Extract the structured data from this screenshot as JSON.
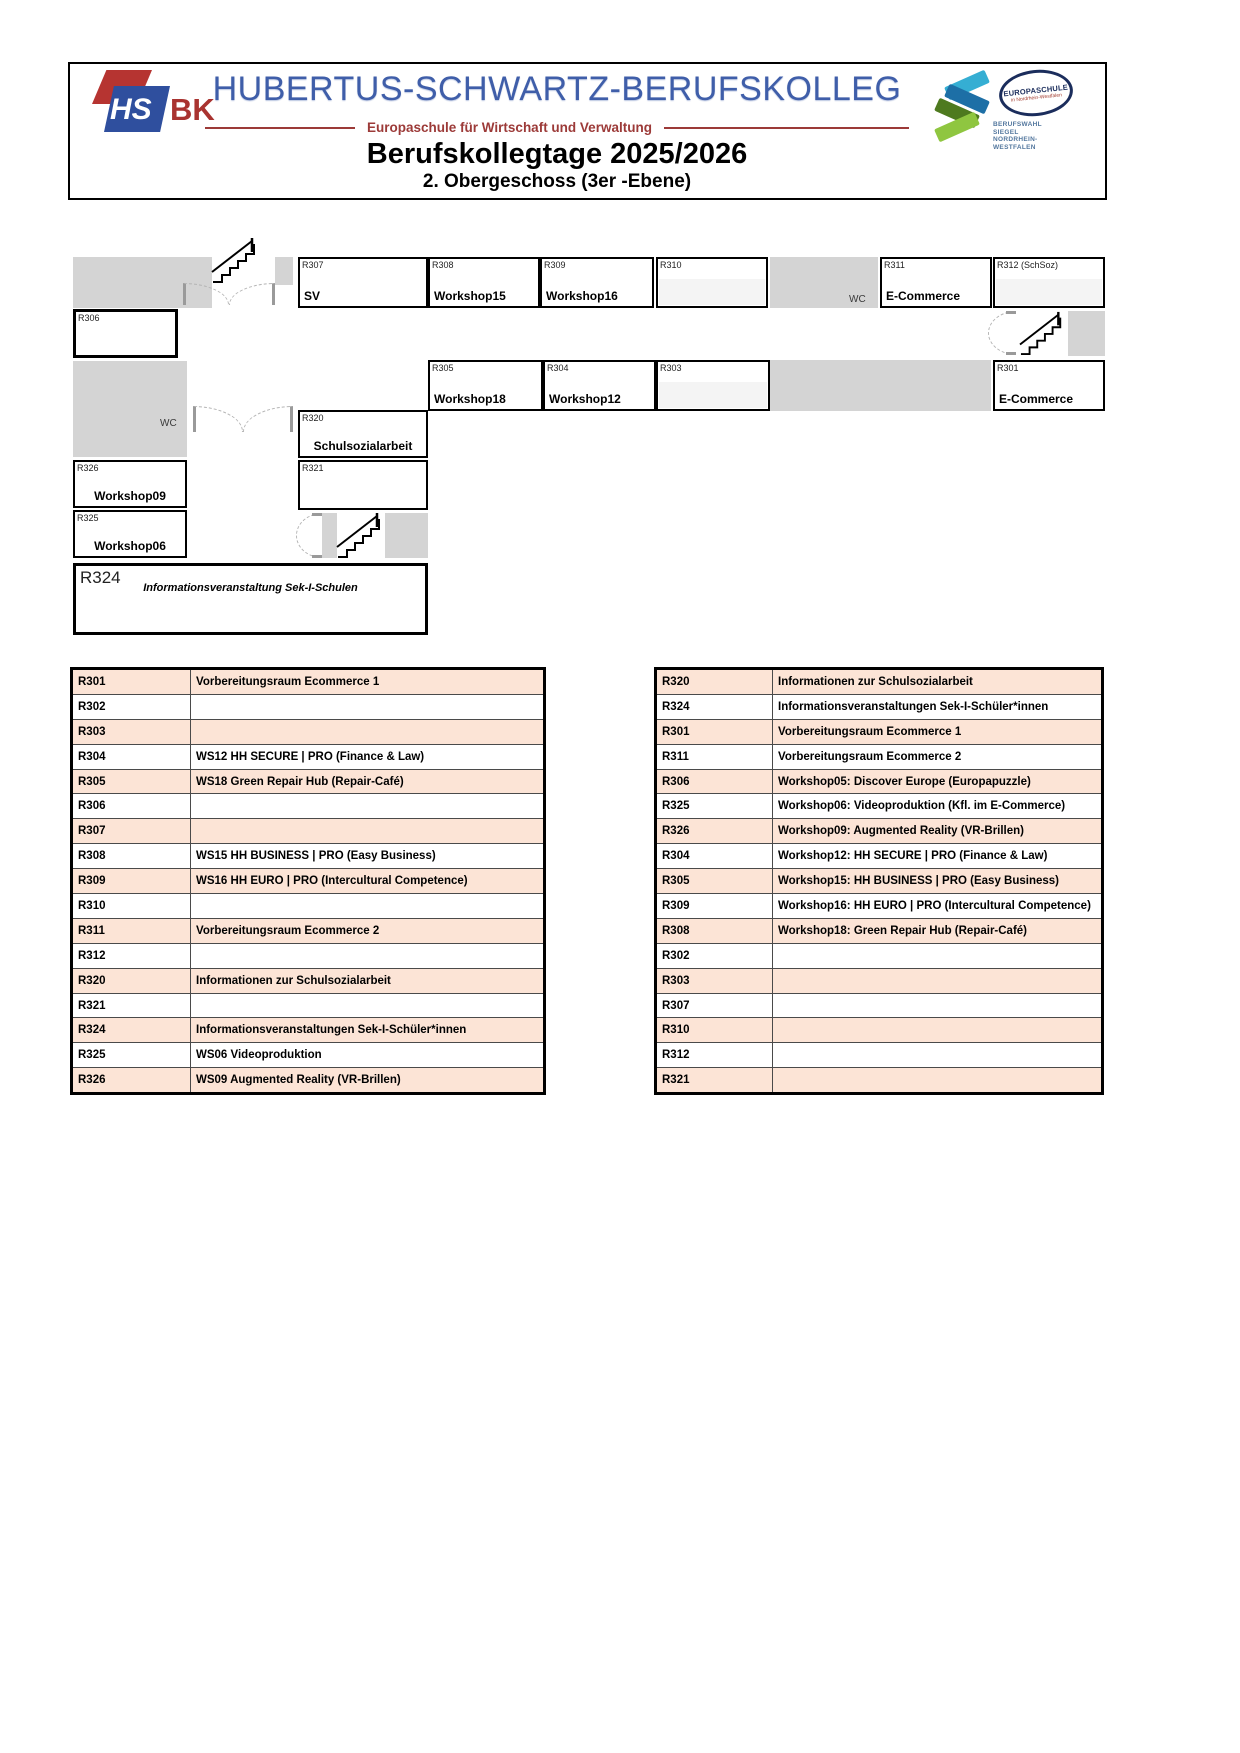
{
  "header": {
    "logo": {
      "hs": "HS",
      "bk": "BK"
    },
    "school_name": "HUBERTUS-SCHWARTZ-BERUFSKOLLEG",
    "subtitle": "Europaschule für Wirtschaft und Verwaltung",
    "event_title": "Berufskollegtage 2025/2026",
    "floor_title": "2. Obergeschoss (3er -Ebene)",
    "europaschule_badge": {
      "line1": "EUROPASCHULE",
      "line2": "in Nordrhein-Westfalen"
    },
    "berufswahl_siegel": [
      "BERUFSWAHL",
      "SIEGEL",
      "NORDRHEIN-",
      "WESTFALEN"
    ]
  },
  "colors": {
    "accent_blue": "#3f5ea9",
    "accent_red": "#9c3a38",
    "table_peach": "#fce4d6",
    "corridor_gray": "#d4d4d4",
    "empty_cell_gray": "#f4f4f4"
  },
  "floor_plan": {
    "wc_label": "WC",
    "rooms": {
      "r307": {
        "id": "R307",
        "label": "SV"
      },
      "r308": {
        "id": "R308",
        "label": "Workshop15"
      },
      "r309": {
        "id": "R309",
        "label": "Workshop16"
      },
      "r310": {
        "id": "R310",
        "label": ""
      },
      "r311": {
        "id": "R311",
        "label": "E-Commerce"
      },
      "r312": {
        "id": "R312 (SchSoz)",
        "label": ""
      },
      "r306": {
        "id": "R306",
        "label": ""
      },
      "r305": {
        "id": "R305",
        "label": "Workshop18"
      },
      "r304": {
        "id": "R304",
        "label": "Workshop12"
      },
      "r303": {
        "id": "R303",
        "label": ""
      },
      "r301": {
        "id": "R301",
        "label": "E-Commerce"
      },
      "r320": {
        "id": "R320",
        "label": "Schulsozialarbeit"
      },
      "r321": {
        "id": "R321",
        "label": ""
      },
      "r326": {
        "id": "R326",
        "label": "Workshop09"
      },
      "r325": {
        "id": "R325",
        "label": "Workshop06"
      },
      "r324": {
        "id": "R324",
        "label": "Informationsveranstaltung Sek-I-Schulen"
      }
    }
  },
  "tables": {
    "left": {
      "rows": [
        {
          "room": "R301",
          "label": "Vorbereitungsraum Ecommerce 1"
        },
        {
          "room": "R302",
          "label": ""
        },
        {
          "room": "R303",
          "label": ""
        },
        {
          "room": "R304",
          "label": "WS12 HH SECURE | PRO (Finance & Law)"
        },
        {
          "room": "R305",
          "label": "WS18 Green Repair Hub (Repair-Café)"
        },
        {
          "room": "R306",
          "label": ""
        },
        {
          "room": "R307",
          "label": ""
        },
        {
          "room": "R308",
          "label": "WS15 HH BUSINESS | PRO (Easy Business)"
        },
        {
          "room": "R309",
          "label": "WS16 HH EURO | PRO (Intercultural Competence)"
        },
        {
          "room": "R310",
          "label": ""
        },
        {
          "room": "R311",
          "label": "Vorbereitungsraum Ecommerce 2"
        },
        {
          "room": "R312",
          "label": ""
        },
        {
          "room": "R320",
          "label": "Informationen zur Schulsozialarbeit"
        },
        {
          "room": "R321",
          "label": ""
        },
        {
          "room": "R324",
          "label": "Informationsveranstaltungen Sek-I-Schüler*innen"
        },
        {
          "room": "R325",
          "label": "WS06 Videoproduktion"
        },
        {
          "room": "R326",
          "label": "WS09 Augmented Reality (VR-Brillen)"
        }
      ]
    },
    "right": {
      "rows": [
        {
          "room": "R320",
          "label": "Informationen zur Schulsozialarbeit"
        },
        {
          "room": "R324",
          "label": "Informationsveranstaltungen Sek-I-Schüler*innen"
        },
        {
          "room": "R301",
          "label": "Vorbereitungsraum Ecommerce 1"
        },
        {
          "room": "R311",
          "label": "Vorbereitungsraum Ecommerce 2"
        },
        {
          "room": "R306",
          "label": "Workshop05: Discover Europe (Europapuzzle)"
        },
        {
          "room": "R325",
          "label": "Workshop06: Videoproduktion (Kfl. im E-Commerce)"
        },
        {
          "room": "R326",
          "label": "Workshop09: Augmented Reality (VR-Brillen)"
        },
        {
          "room": "R304",
          "label": "Workshop12: HH SECURE | PRO (Finance & Law)"
        },
        {
          "room": "R305",
          "label": "Workshop15: HH BUSINESS | PRO (Easy Business)"
        },
        {
          "room": "R309",
          "label": "Workshop16: HH EURO | PRO (Intercultural Competence)"
        },
        {
          "room": "R308",
          "label": "Workshop18: Green Repair Hub (Repair-Café)"
        },
        {
          "room": "R302",
          "label": ""
        },
        {
          "room": "R303",
          "label": ""
        },
        {
          "room": "R307",
          "label": ""
        },
        {
          "room": "R310",
          "label": ""
        },
        {
          "room": "R312",
          "label": ""
        },
        {
          "room": "R321",
          "label": ""
        }
      ]
    }
  }
}
